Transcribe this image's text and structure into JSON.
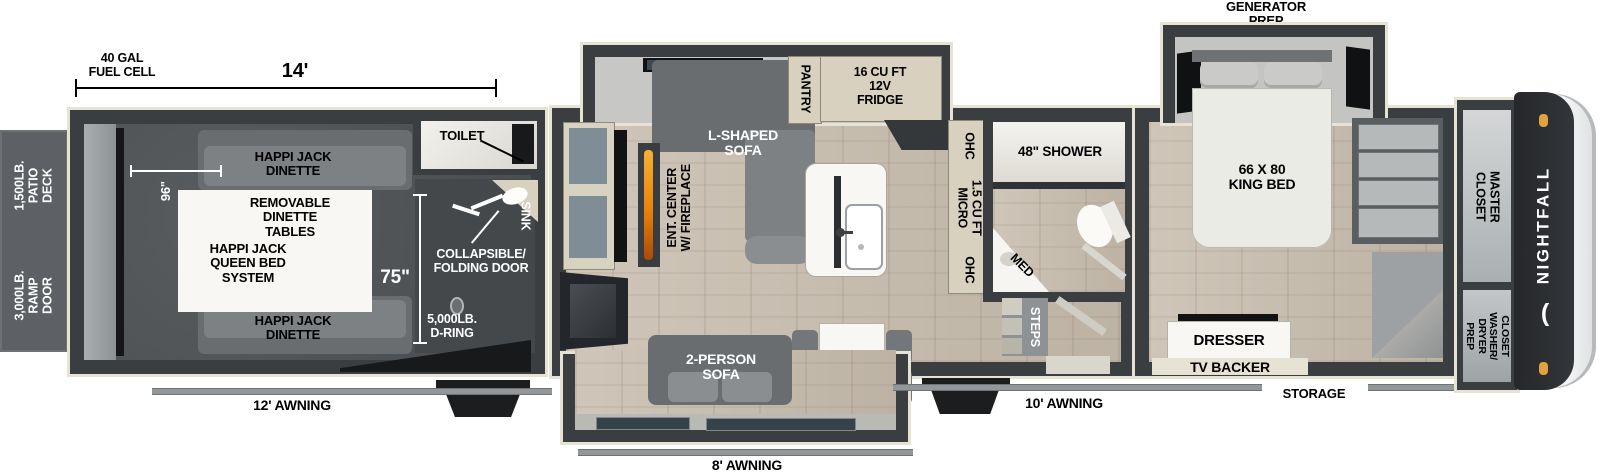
{
  "brand": {
    "name": "NIGHTFALL",
    "crescent_icon": "("
  },
  "colors": {
    "wall": "#3b3e41",
    "trim": "#e6e2d4",
    "garage_floor": "#4f5356",
    "wood_floor": "#c7bcad",
    "cabinet_tan": "#d8d1bf",
    "sofa_gray": "#7d8184",
    "white_furniture": "#f8f7f4",
    "brand_cap": "#25272a",
    "accent_orange": "#e2a23f",
    "flame_orange": "#e8820c"
  },
  "dimensions": {
    "fuel_cell": "40 GAL\nFUEL CELL",
    "garage_length": "14'",
    "garage_width": "96\"",
    "garage_interior": "75\""
  },
  "exterior": {
    "patio_deck": "1,500LB.\nPATIO DECK",
    "ramp_door": "3,000LB.\nRAMP DOOR",
    "awning_garage": "12' AWNING",
    "awning_living": "8' AWNING",
    "awning_main": "10' AWNING",
    "generator_prep": "GENERATOR\nPREP",
    "storage": "STORAGE"
  },
  "garage": {
    "toilet": "TOILET",
    "sink": "SINK",
    "dinette_top": "HAPPI JACK\nDINETTE",
    "removable_tables": "REMOVABLE\nDINETTE\nTABLES",
    "queen_bed_system": "HAPPI JACK\nQUEEN BED\nSYSTEM",
    "dinette_bottom": "HAPPI JACK\nDINETTE",
    "folding_door": "COLLAPSIBLE/\nFOLDING DOOR",
    "d_ring": "5,000LB.\nD-RING"
  },
  "living": {
    "ent_center": "ENT. CENTER\nW/ FIREPLACE",
    "l_shaped_sofa": "L-SHAPED\nSOFA",
    "pantry": "PANTRY",
    "fridge": "16 CU FT\n12V\nFRIDGE",
    "two_person_sofa": "2-PERSON\nSOFA",
    "ohc_top": "OHC",
    "micro": "1.5 CU FT\nMICRO",
    "ohc_bottom": "OHC"
  },
  "bath": {
    "shower": "48\" SHOWER",
    "med": "MED",
    "steps": "STEPS"
  },
  "bedroom": {
    "king_bed": "66 X 80\nKING BED",
    "dresser": "DRESSER",
    "tv_backer": "TV BACKER",
    "master_closet": "MASTER\nCLOSET",
    "washer_dryer": "CLOSET\nWASHER/\nDRYER\nPREP"
  }
}
